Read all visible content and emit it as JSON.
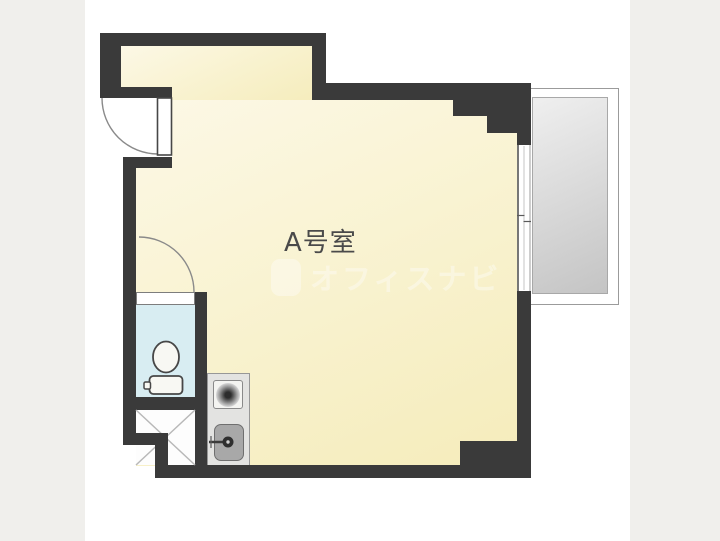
{
  "floorplan": {
    "room_label": "A号室",
    "watermark_text": "オフィスナビ",
    "features": {
      "entrance_door": "hinged-door-top-left",
      "toilet": "toilet-room-with-wc",
      "kitchen": "mini-kitchen-burner-and-sink",
      "window": "sliding-window-right-wall",
      "balcony": "balcony-right-side"
    },
    "colors": {
      "canvasBg": "#ffffff",
      "sideBand": "#f0efec",
      "wall": "#3a3a3a",
      "roomA": "#fcf8e6",
      "roomB": "#f5ecbb",
      "toiletFill": "#d8edf2",
      "balconyA": "#efefef",
      "balconyB": "#c4c4c4",
      "balconyBorder": "#9b9b9b",
      "kitchenFill": "#e3e3e1",
      "kitchenBorder": "#979797",
      "burnerBoxFill": "#f4f4f1",
      "sinkFill": "#a8a8a8",
      "sinkBorder": "#6f6f6f",
      "doorStroke": "#8a8a8a",
      "fixtureStroke": "#474747",
      "fixtureFill": "#f8f8f3",
      "xLine": "#b8b8b8",
      "windowDark": "#4a4a4a",
      "windowLight": "#9e9e9e",
      "labelColor": "#4a4a4a",
      "watermarkColor": "#ffffff"
    }
  }
}
